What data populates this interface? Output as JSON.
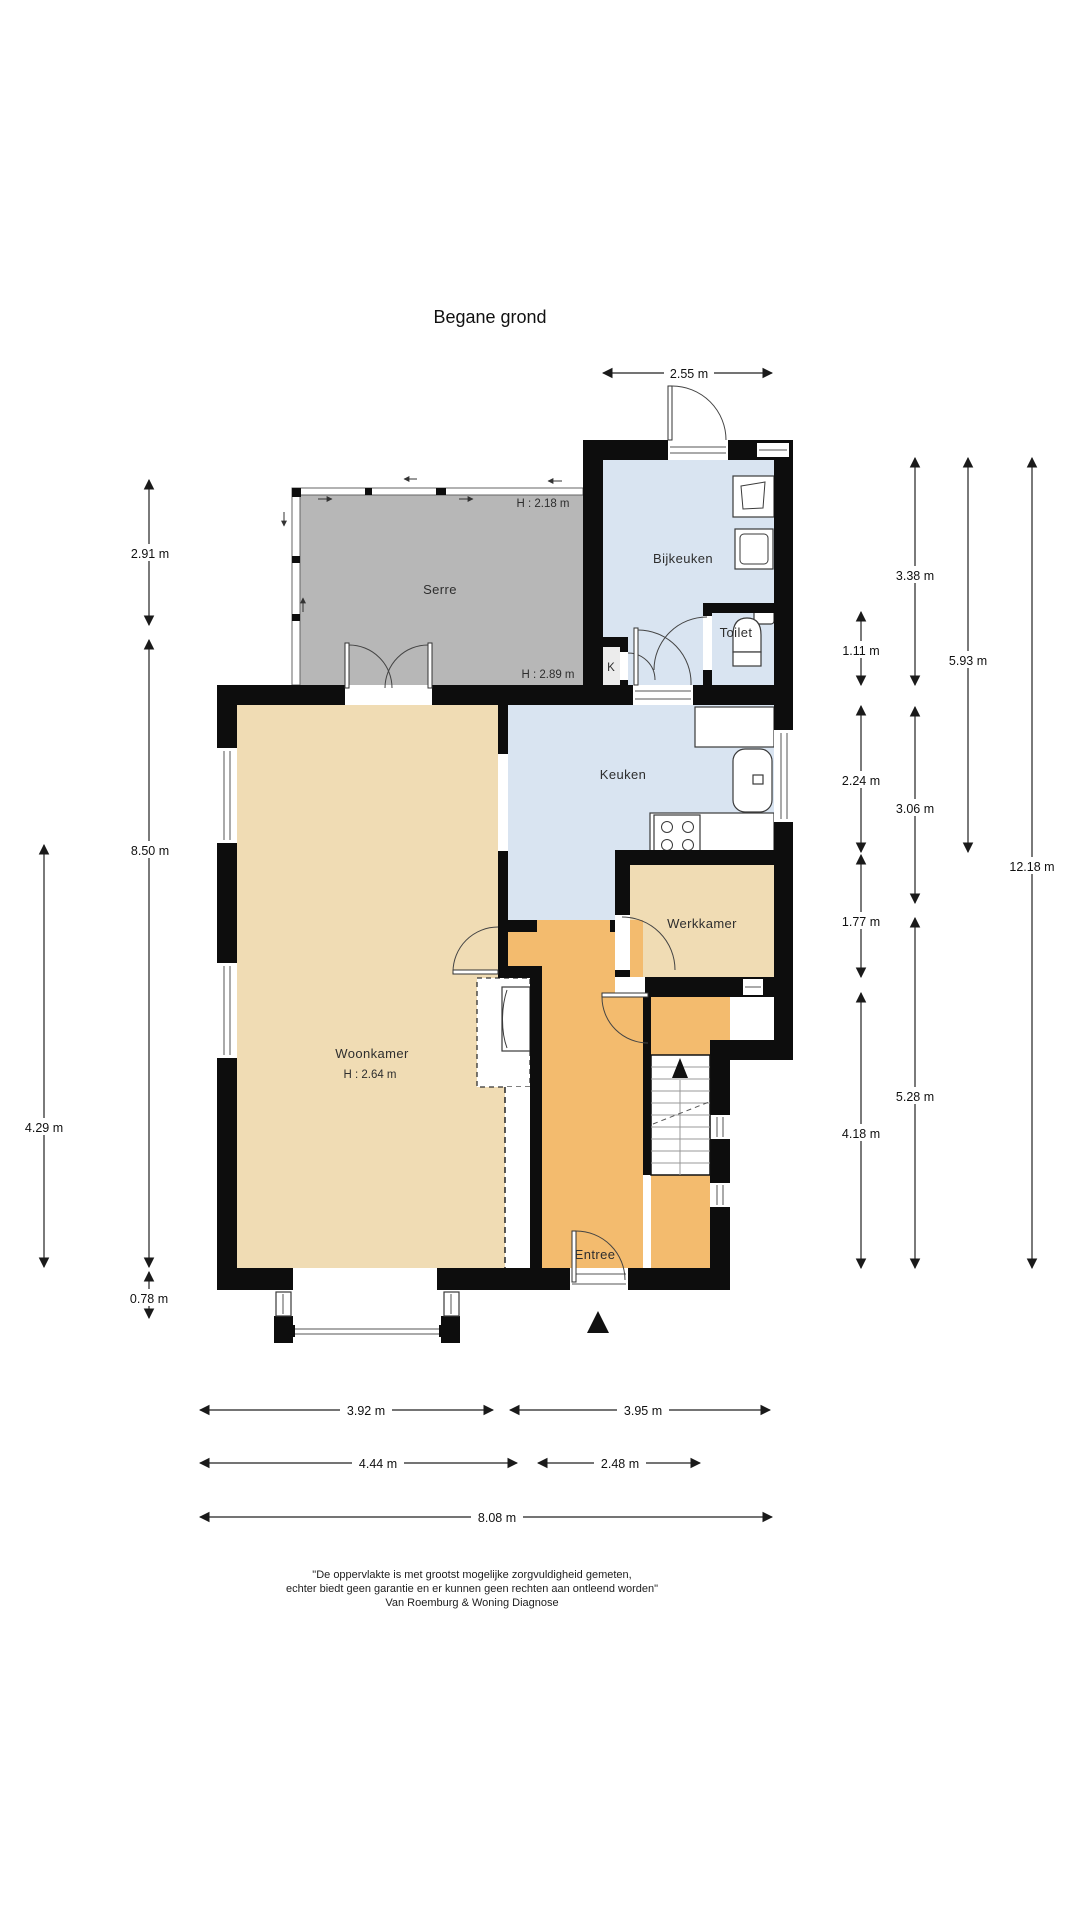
{
  "title": "Begane grond",
  "colors": {
    "wall": "#0d0d0d",
    "room-blue": "#d9e4f1",
    "room-tan": "#f0dcb4",
    "room-orange": "#f3bb6e",
    "room-serre": "#b7b7b7",
    "line": "#222222",
    "text": "#2e2e2e"
  },
  "rooms": {
    "serre": {
      "label": "Serre",
      "h_label_top": "H : 2.18 m",
      "h_label_bottom": "H : 2.89 m"
    },
    "bijkeuken": {
      "label": "Bijkeuken"
    },
    "toilet": {
      "label": "Toilet"
    },
    "closet": {
      "label": "K"
    },
    "keuken": {
      "label": "Keuken"
    },
    "werkkamer": {
      "label": "Werkkamer"
    },
    "woonkamer": {
      "label": "Woonkamer",
      "h_label": "H : 2.64 m"
    },
    "entree": {
      "label": "Entree"
    }
  },
  "dimensions": {
    "top": {
      "bijkeuken_width": "2.55 m"
    },
    "left": {
      "serre_height": "2.91 m",
      "house_height": "8.50 m",
      "woonkamer_lower": "4.29 m",
      "bay_depth": "0.78 m"
    },
    "right": {
      "bijkeuken": "3.38 m",
      "toilet": "1.11 m",
      "upper_total": "5.93 m",
      "keuken": "2.24 m",
      "keuken_total": "3.06 m",
      "total": "12.18 m",
      "werkkamer": "1.77 m",
      "lower_total": "5.28 m",
      "entree": "4.18 m"
    },
    "bottom": {
      "woonkamer": "3.92 m",
      "entree": "3.95 m",
      "left_total": "4.44 m",
      "right_total": "2.48 m",
      "total": "8.08 m"
    }
  },
  "footer": {
    "line1": "\"De oppervlakte is met grootst mogelijke zorgvuldigheid gemeten,",
    "line2": "echter biedt geen garantie en er kunnen geen rechten aan ontleend worden\"",
    "line3": "Van Roemburg & Woning Diagnose"
  }
}
